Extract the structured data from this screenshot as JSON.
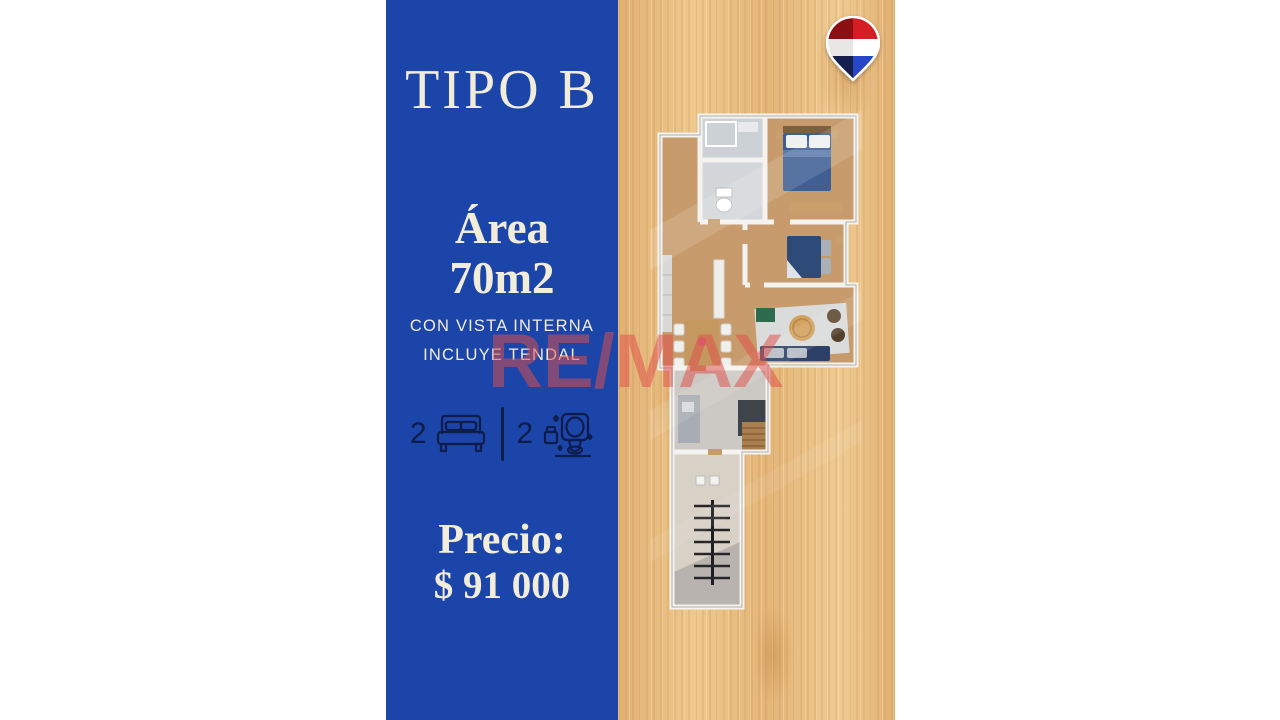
{
  "panel": {
    "title": "TIPO B",
    "area_label": "Área",
    "area_value": "70m2",
    "features": [
      "CON VISTA INTERNA",
      "INCLUYE TENDAL"
    ],
    "bedrooms": "2",
    "bathrooms": "2",
    "price_label": "Precio:",
    "price_value": "$ 91 000"
  },
  "watermark": {
    "text": "RE/MAX"
  },
  "icons": {
    "bedrooms_icon": "double-bed-icon",
    "bathrooms_icon": "toilet-icon",
    "brand_icon": "remax-balloon-icon"
  },
  "colors": {
    "panel_blue": "#1c45a9",
    "text_cream": "#f2ecda",
    "icon_navy": "#0d1c4b",
    "wood_base": "#e6ba7e",
    "watermark_red": "#e0504a",
    "balloon_red": "#d41e24",
    "balloon_blue": "#2746c8",
    "plan_floor": "#c79b6b",
    "bed_blue": "#3f5f93"
  }
}
